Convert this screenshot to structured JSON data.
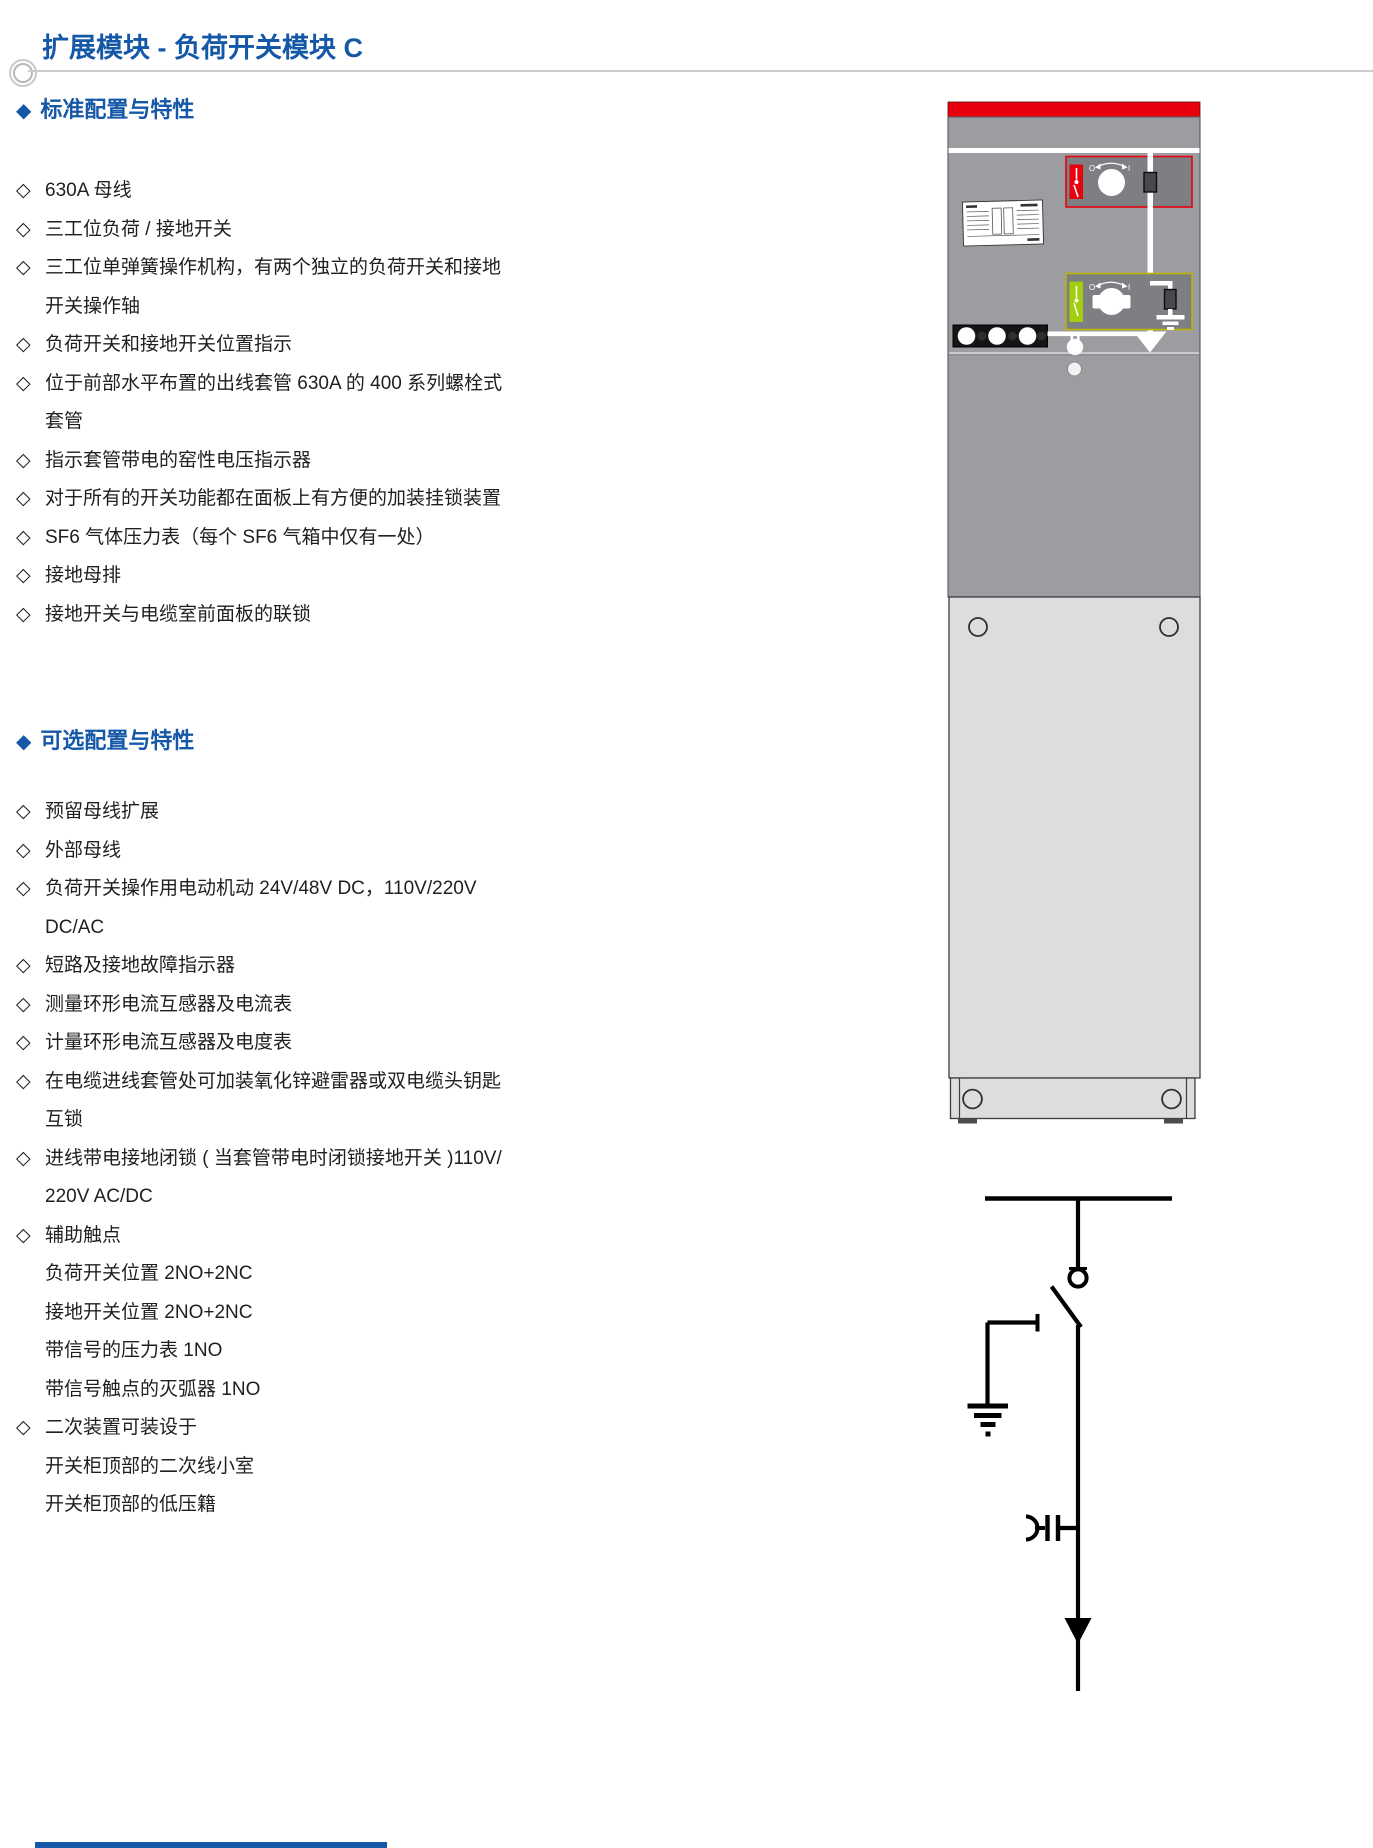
{
  "page_title": "扩展模块 - 负荷开关模块 C",
  "icons": {
    "hollow_diamond": "◇",
    "filled_diamond": "◆"
  },
  "sections": [
    {
      "heading": "标准配置与特性",
      "lines": [
        {
          "bullet": true,
          "text": "630A 母线"
        },
        {
          "bullet": true,
          "text": "三工位负荷 / 接地开关"
        },
        {
          "bullet": true,
          "text": "三工位单弹簧操作机构，有两个独立的负荷开关和接地"
        },
        {
          "bullet": false,
          "text": "开关操作轴"
        },
        {
          "bullet": true,
          "text": "负荷开关和接地开关位置指示"
        },
        {
          "bullet": true,
          "text": "位于前部水平布置的出线套管 630A 的 400 系列螺栓式"
        },
        {
          "bullet": false,
          "text": "套管"
        },
        {
          "bullet": true,
          "text": "指示套管带电的窑性电压指示器"
        },
        {
          "bullet": true,
          "text": "对于所有的开关功能都在面板上有方便的加装挂锁装置"
        },
        {
          "bullet": true,
          "text": "SF6 气体压力表（每个 SF6 气箱中仅有一处）"
        },
        {
          "bullet": true,
          "text": "接地母排"
        },
        {
          "bullet": true,
          "text": "接地开关与电缆室前面板的联锁"
        }
      ]
    },
    {
      "heading": "可选配置与特性",
      "lines": [
        {
          "bullet": true,
          "text": "预留母线扩展"
        },
        {
          "bullet": true,
          "text": "外部母线"
        },
        {
          "bullet": true,
          "text": "负荷开关操作用电动机动 24V/48V DC，110V/220V"
        },
        {
          "bullet": false,
          "text": "DC/AC"
        },
        {
          "bullet": true,
          "text": "短路及接地故障指示器"
        },
        {
          "bullet": true,
          "text": "测量环形电流互感器及电流表"
        },
        {
          "bullet": true,
          "text": "计量环形电流互感器及电度表"
        },
        {
          "bullet": true,
          "text": "在电缆进线套管处可加装氧化锌避雷器或双电缆头钥匙"
        },
        {
          "bullet": false,
          "text": "互锁"
        },
        {
          "bullet": true,
          "text": "进线带电接地闭锁 ( 当套管带电时闭锁接地开关 )110V/"
        },
        {
          "bullet": false,
          "text": "220V AC/DC"
        },
        {
          "bullet": true,
          "text": "辅助触点"
        },
        {
          "bullet": false,
          "text": "负荷开关位置 2NO+2NC"
        },
        {
          "bullet": false,
          "text": "接地开关位置 2NO+2NC"
        },
        {
          "bullet": false,
          "text": "带信号的压力表 1NO"
        },
        {
          "bullet": false,
          "text": "带信号触点的灭弧器 1NO"
        },
        {
          "bullet": true,
          "text": "二次装置可装设于"
        },
        {
          "bullet": false,
          "text": "开关柜顶部的二次线小室"
        },
        {
          "bullet": false,
          "text": "开关柜顶部的低压籍"
        }
      ]
    }
  ],
  "figure": {
    "switch_labels": {
      "off": "O",
      "on": "I"
    }
  },
  "colors": {
    "accent_blue": "#1558a7",
    "text_dark": "#1f1f1f",
    "rule_gray": "#cdcdcd",
    "cabinet_red": "#e8000f",
    "panel_gray": "#9c9da0",
    "box_gray": "#7d7f82",
    "door_gray": "#dcdddd",
    "strip_black": "#141414",
    "yellow_outline": "#b8b400",
    "green_stripe": "#a2ce0e",
    "connector_dark": "#47494b"
  }
}
